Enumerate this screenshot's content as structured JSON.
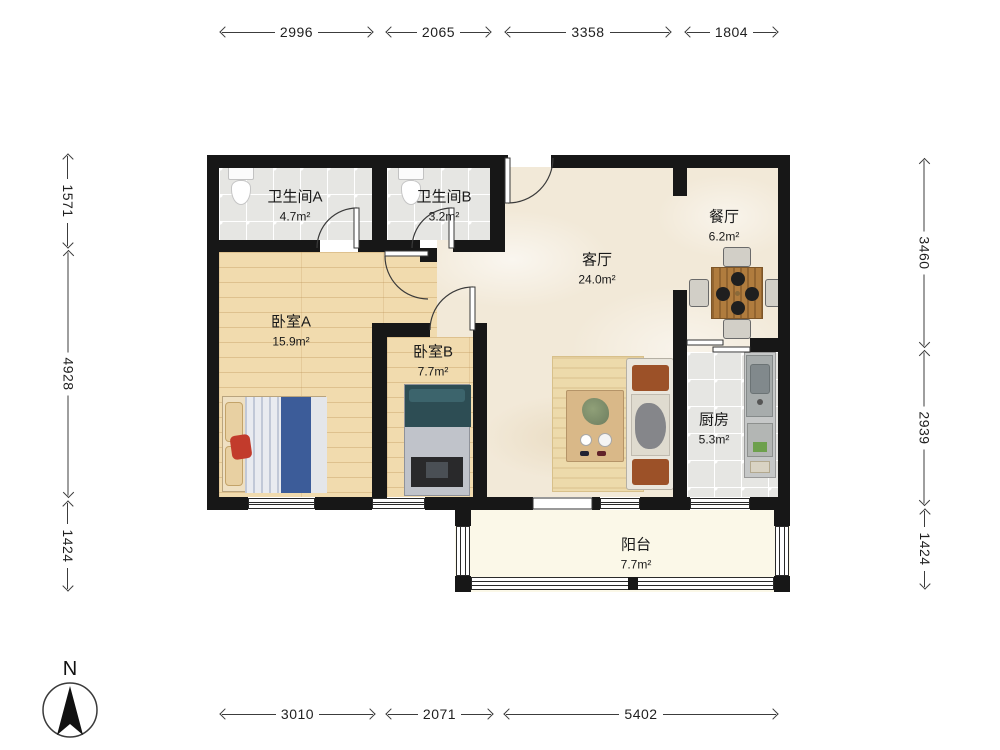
{
  "compass": {
    "label": "N"
  },
  "rooms": {
    "bathroom_a": {
      "name": "卫生间A",
      "area": "4.7m²"
    },
    "bathroom_b": {
      "name": "卫生间B",
      "area": "3.2m²"
    },
    "bedroom_a": {
      "name": "卧室A",
      "area": "15.9m²"
    },
    "bedroom_b": {
      "name": "卧室B",
      "area": "7.7m²"
    },
    "living_room": {
      "name": "客厅",
      "area": "24.0m²"
    },
    "dining_room": {
      "name": "餐厅",
      "area": "6.2m²"
    },
    "kitchen": {
      "name": "厨房",
      "area": "5.3m²"
    },
    "balcony": {
      "name": "阳台",
      "area": "7.7m²"
    }
  },
  "dimensions": {
    "top": [
      {
        "value": "2996"
      },
      {
        "value": "2065"
      },
      {
        "value": "3358"
      },
      {
        "value": "1804"
      }
    ],
    "bottom": [
      {
        "value": "3010"
      },
      {
        "value": "2071"
      },
      {
        "value": "5402"
      }
    ],
    "left": [
      {
        "value": "1571"
      },
      {
        "value": "4928"
      },
      {
        "value": "1424"
      }
    ],
    "right": [
      {
        "value": "3460"
      },
      {
        "value": "2939"
      },
      {
        "value": "1424"
      }
    ]
  },
  "colors": {
    "wall": "#171717",
    "marble": "#f2e9d8",
    "wood": "#f1dbae",
    "tile": "#e6e6e3",
    "balcony": "#fbf8e8",
    "accent_blue": "#3c5c99",
    "accent_teal": "#2d4d54"
  }
}
